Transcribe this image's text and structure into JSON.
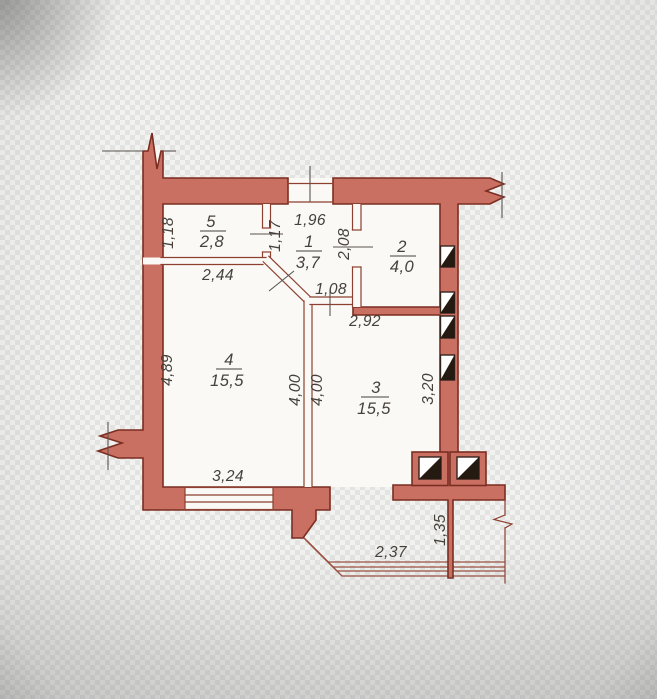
{
  "plan": {
    "rooms": [
      {
        "number": "5",
        "area": "2,8"
      },
      {
        "number": "1",
        "area": "3,7"
      },
      {
        "number": "2",
        "area": "4,0"
      },
      {
        "number": "4",
        "area": "15,5"
      },
      {
        "number": "3",
        "area": "15,5"
      }
    ],
    "dimensions": {
      "room5_height": "1,18",
      "room5_width": "2,44",
      "room5_door": "1,17",
      "entrance_width": "1,96",
      "room2_door": "2,08",
      "room3_opening": "1,08",
      "room3_top_width": "2,92",
      "room4_height": "4,89",
      "divider_left": "4,00",
      "divider_right": "4,00",
      "room3_right_height": "3,20",
      "room4_window_width": "3,24",
      "balcony_width": "2,37",
      "balcony_side": "1,35"
    },
    "colors": {
      "wall_fill": "#c97062",
      "wall_outline": "#7b2d21",
      "thin_outline": "#8d4030",
      "text_color": "#46413b",
      "railing": "#9a4f40",
      "vent_fill": "#241a12",
      "paper": "#fbf9f6",
      "bg_light": "#f2f2f1",
      "bg_dark": "#e3e3e2"
    },
    "symbols": {
      "vent_shaft": "square-with-black-diagonal-half",
      "wall_break": "zigzag",
      "window": "triple-line-band",
      "balcony_railing": "four-parallel-lines"
    }
  }
}
